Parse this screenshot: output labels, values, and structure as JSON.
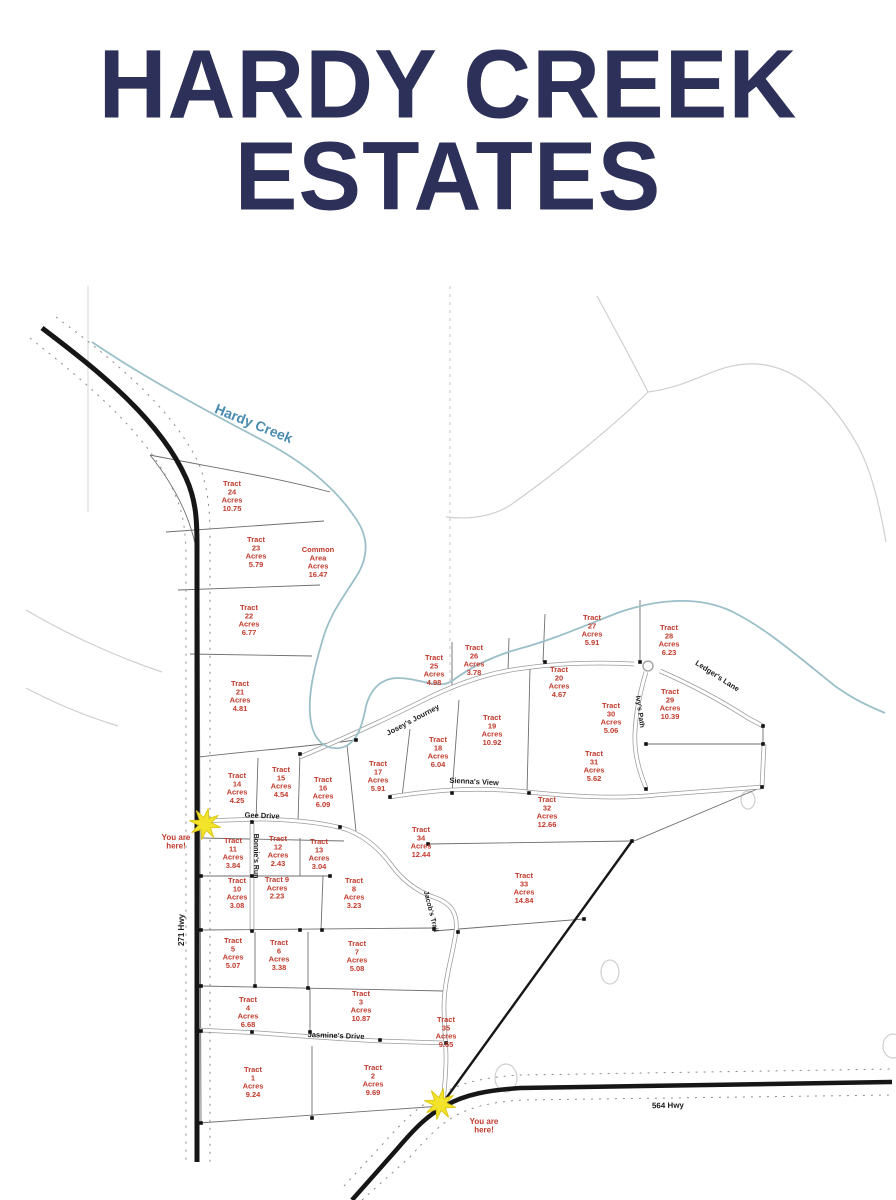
{
  "title": {
    "line1": "HARDY CREEK",
    "line2": "ESTATES"
  },
  "colors": {
    "title_navy": "#2d3058",
    "tract_red": "#c13a2c",
    "creek_blue": "#4a8bb0",
    "star_yellow": "#f3e32a",
    "road_black": "#1a1a1a"
  },
  "map": {
    "creek_label": {
      "text": "Hardy Creek",
      "x": 252,
      "y": 428,
      "rotate": 22,
      "size": 14
    },
    "streets": [
      {
        "name": "Gee Drive",
        "x": 262,
        "y": 818,
        "rotate": 2,
        "size": 7.5
      },
      {
        "name": "Bonnie's Run",
        "x": 254,
        "y": 856,
        "rotate": 90,
        "size": 7
      },
      {
        "name": "Josey's Journey",
        "x": 414,
        "y": 722,
        "rotate": -28,
        "size": 7.5
      },
      {
        "name": "Sienna's View",
        "x": 474,
        "y": 784,
        "rotate": 3,
        "size": 7.5
      },
      {
        "name": "Ivy's Path",
        "x": 638,
        "y": 712,
        "rotate": 82,
        "size": 7
      },
      {
        "name": "Ledger's Lane",
        "x": 716,
        "y": 678,
        "rotate": 33,
        "size": 7.5
      },
      {
        "name": "Jacob's Trail",
        "x": 429,
        "y": 912,
        "rotate": 76,
        "size": 7
      },
      {
        "name": "Jasmine's Drive",
        "x": 336,
        "y": 1038,
        "rotate": 2,
        "size": 7.5
      },
      {
        "name": "271 Hwy",
        "x": 184,
        "y": 930,
        "rotate": -90,
        "size": 8
      },
      {
        "name": "564 Hwy",
        "x": 668,
        "y": 1108,
        "rotate": -1,
        "size": 8
      }
    ],
    "tracts": [
      {
        "lines": [
          "Tract",
          "24",
          "Acres",
          "10.75"
        ],
        "x": 232,
        "y": 486
      },
      {
        "lines": [
          "Tract",
          "23",
          "Acres",
          "5.79"
        ],
        "x": 256,
        "y": 542
      },
      {
        "lines": [
          "Common",
          "Area",
          "Acres",
          "16.47"
        ],
        "x": 318,
        "y": 552
      },
      {
        "lines": [
          "Tract",
          "22",
          "Acres",
          "6.77"
        ],
        "x": 249,
        "y": 610
      },
      {
        "lines": [
          "Tract",
          "21",
          "Acres",
          "4.81"
        ],
        "x": 240,
        "y": 686
      },
      {
        "lines": [
          "Tract",
          "14",
          "Acres",
          "4.25"
        ],
        "x": 237,
        "y": 778
      },
      {
        "lines": [
          "Tract",
          "15",
          "Acres",
          "4.54"
        ],
        "x": 281,
        "y": 772
      },
      {
        "lines": [
          "Tract",
          "16",
          "Acres",
          "6.09"
        ],
        "x": 323,
        "y": 782
      },
      {
        "lines": [
          "Tract",
          "17",
          "Acres",
          "5.91"
        ],
        "x": 378,
        "y": 766
      },
      {
        "lines": [
          "Tract",
          "18",
          "Acres",
          "6.04"
        ],
        "x": 438,
        "y": 742
      },
      {
        "lines": [
          "Tract",
          "19",
          "Acres",
          "10.92"
        ],
        "x": 492,
        "y": 720
      },
      {
        "lines": [
          "Tract",
          "25",
          "Acres",
          "4.98"
        ],
        "x": 434,
        "y": 660
      },
      {
        "lines": [
          "Tract",
          "26",
          "Acres",
          "3.78"
        ],
        "x": 474,
        "y": 650
      },
      {
        "lines": [
          "Tract",
          "27",
          "Acres",
          "5.91"
        ],
        "x": 592,
        "y": 620
      },
      {
        "lines": [
          "Tract",
          "28",
          "Acres",
          "6.23"
        ],
        "x": 669,
        "y": 630
      },
      {
        "lines": [
          "Tract",
          "20",
          "Acres",
          "4.67"
        ],
        "x": 559,
        "y": 672
      },
      {
        "lines": [
          "Tract",
          "30",
          "Acres",
          "5.06"
        ],
        "x": 611,
        "y": 708
      },
      {
        "lines": [
          "Tract",
          "29",
          "Acres",
          "10.39"
        ],
        "x": 670,
        "y": 694
      },
      {
        "lines": [
          "Tract",
          "31",
          "Acres",
          "5.62"
        ],
        "x": 594,
        "y": 756
      },
      {
        "lines": [
          "Tract",
          "32",
          "Acres",
          "12.66"
        ],
        "x": 547,
        "y": 802
      },
      {
        "lines": [
          "Tract",
          "34",
          "Acres",
          "12.44"
        ],
        "x": 421,
        "y": 832
      },
      {
        "lines": [
          "Tract",
          "33",
          "Acres",
          "14.84"
        ],
        "x": 524,
        "y": 878
      },
      {
        "lines": [
          "Tract",
          "11",
          "Acres",
          "3.84"
        ],
        "x": 233,
        "y": 843
      },
      {
        "lines": [
          "Tract",
          "12",
          "Acres",
          "2.43"
        ],
        "x": 278,
        "y": 841
      },
      {
        "lines": [
          "Tract",
          "13",
          "Acres",
          "3.04"
        ],
        "x": 319,
        "y": 844
      },
      {
        "lines": [
          "Tract",
          "10",
          "Acres",
          "3.08"
        ],
        "x": 237,
        "y": 883
      },
      {
        "lines": [
          "Tract 9",
          "Acres",
          "2.23"
        ],
        "x": 277,
        "y": 882
      },
      {
        "lines": [
          "Tract",
          "8",
          "Acres",
          "3.23"
        ],
        "x": 354,
        "y": 883
      },
      {
        "lines": [
          "Tract",
          "5",
          "Acres",
          "5.07"
        ],
        "x": 233,
        "y": 943
      },
      {
        "lines": [
          "Tract",
          "6",
          "Acres",
          "3.38"
        ],
        "x": 279,
        "y": 945
      },
      {
        "lines": [
          "Tract",
          "7",
          "Acres",
          "5.08"
        ],
        "x": 357,
        "y": 946
      },
      {
        "lines": [
          "Tract",
          "4",
          "Acres",
          "6.68"
        ],
        "x": 248,
        "y": 1002
      },
      {
        "lines": [
          "Tract",
          "3",
          "Acres",
          "10.87"
        ],
        "x": 361,
        "y": 996
      },
      {
        "lines": [
          "Tract",
          "35",
          "Acres",
          "9.65"
        ],
        "x": 446,
        "y": 1022
      },
      {
        "lines": [
          "Tract",
          "1",
          "Acres",
          "9.24"
        ],
        "x": 253,
        "y": 1072
      },
      {
        "lines": [
          "Tract",
          "2",
          "Acres",
          "9.69"
        ],
        "x": 373,
        "y": 1070
      }
    ],
    "markers": [
      {
        "label_lines": [
          "You are",
          "here!"
        ],
        "star_x": 205,
        "star_y": 824,
        "label_x": 176,
        "label_y": 840
      },
      {
        "label_lines": [
          "You are",
          "here!"
        ],
        "star_x": 440,
        "star_y": 1104,
        "label_x": 484,
        "label_y": 1124
      }
    ]
  }
}
